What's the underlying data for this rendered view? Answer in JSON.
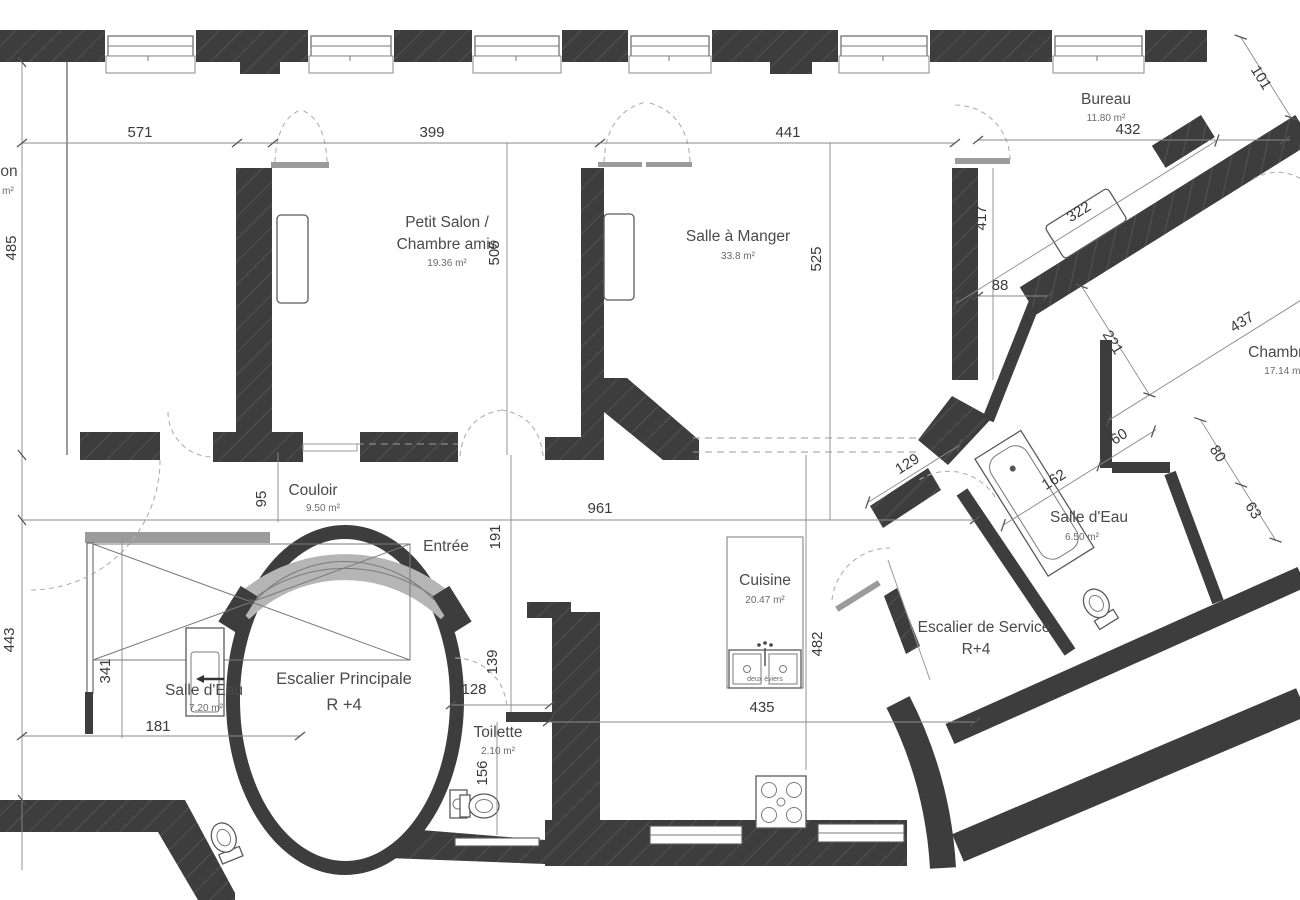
{
  "drawing": {
    "kind": "architectural floor plan",
    "units_note": "cm"
  },
  "rooms": [
    {
      "id": "salon-gauche-partiel",
      "name": "on",
      "area": "m²"
    },
    {
      "id": "petit-salon",
      "name": "Petit Salon /",
      "name2": "Chambre amis",
      "area": "19.36 m²"
    },
    {
      "id": "salle-a-manger",
      "name": "Salle à Manger",
      "area": "33.8 m²"
    },
    {
      "id": "bureau",
      "name": "Bureau",
      "area": "11.80 m²"
    },
    {
      "id": "chambre",
      "name": "Chambre",
      "area": "17.14 m²"
    },
    {
      "id": "couloir",
      "name": "Couloir",
      "area": "9.50 m²"
    },
    {
      "id": "entree",
      "name": "Entrée"
    },
    {
      "id": "cuisine",
      "name": "Cuisine",
      "area": "20.47 m²"
    },
    {
      "id": "salle-eau-droite",
      "name": "Salle d'Eau",
      "area": "6.50 m²"
    },
    {
      "id": "salle-eau-gauche",
      "name": "Salle d'Eau",
      "area": "7.20 m²"
    },
    {
      "id": "toilette",
      "name": "Toilette",
      "area": "2.10 m²"
    },
    {
      "id": "escalier-principale",
      "name": "Escalier Principale",
      "level": "R +4"
    },
    {
      "id": "escalier-service",
      "name": "Escalier de Service",
      "level": "R+4"
    }
  ],
  "dims": {
    "v571": "571",
    "v399": "399",
    "v441": "441",
    "v432": "432",
    "v485": "485",
    "v505": "505",
    "v525": "525",
    "v417": "417",
    "v88": "88",
    "v101": "101",
    "v322": "322",
    "v437": "437",
    "v221": "221",
    "v60": "60",
    "v80": "80",
    "v63": "63",
    "v162": "162",
    "v129": "129",
    "v95": "95",
    "v961": "961",
    "v191": "191",
    "v443": "443",
    "v341": "341",
    "v181": "181",
    "v139": "139",
    "v128": "128",
    "v156": "156",
    "v435": "435",
    "v482": "482"
  },
  "fixtures": {
    "kitchen_sink_label": "deux éviers"
  }
}
